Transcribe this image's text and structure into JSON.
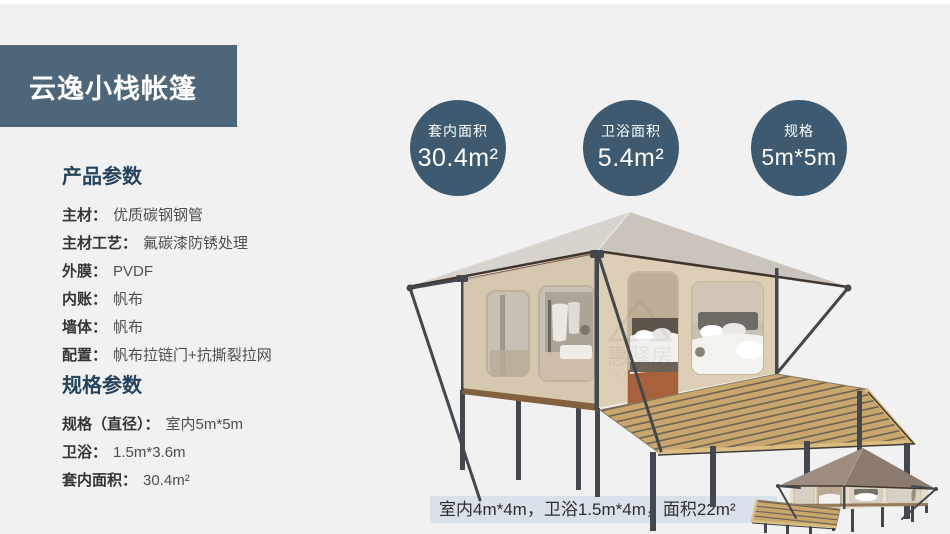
{
  "title_banner": {
    "label": "云逸小栈帐篷"
  },
  "product_params": {
    "heading": "产品参数",
    "items": [
      {
        "label": "主材：",
        "value": "优质碳钢钢管"
      },
      {
        "label": "主材工艺：",
        "value": "氟碳漆防锈处理"
      },
      {
        "label": "外膜：",
        "value": "PVDF"
      },
      {
        "label": "内账：",
        "value": "帆布"
      },
      {
        "label": "墙体：",
        "value": "帆布"
      },
      {
        "label": "配置：",
        "value": "帆布拉链门+抗撕裂拉网"
      }
    ]
  },
  "spec_params": {
    "heading": "规格参数",
    "items": [
      {
        "label": "规格（直径）：",
        "value": "室内5m*5m"
      },
      {
        "label": "卫浴：",
        "value": "1.5m*3.6m"
      },
      {
        "label": "套内面积：",
        "value": "30.4m²"
      }
    ]
  },
  "stat_circles": [
    {
      "label": "套内面积",
      "value": "30.4m²"
    },
    {
      "label": "卫浴面积",
      "value": "5.4m²"
    },
    {
      "label": "规格",
      "value": "5m*5m"
    }
  ],
  "caption": {
    "text": "室内4m*4m，卫浴1.5m*4m，面积22m²"
  },
  "watermark": {
    "text": "惠驿房",
    "subtext": "YIFANT"
  },
  "colors": {
    "page_bg": "#f1f1f2",
    "banner_bg": "#4d6679",
    "heading_color": "#24435f",
    "label_color": "#353535",
    "value_color": "#4f4f4f",
    "circle_bg": "#3d5a70",
    "caption_bg": "#d9e2ea",
    "caption_text": "#2e2e2e",
    "roof_left": "#d9d3cd",
    "roof_right": "#cbc4bc",
    "roof_edge": "#40362d",
    "roof_accent": "#7a4535",
    "wall_side": "#d5c8af",
    "wall_front": "#dccfb5",
    "baseboard": "#82613f",
    "window_glass": "#c7c1b5",
    "door_interior": "#bfae97",
    "floor_red": "#a8613b",
    "deck_tan": "#c9a76c",
    "deck_gap": "#6a6156",
    "deck_edge": "#dcbd80",
    "deck_dark": "#3e3a34",
    "metal": "#43474e",
    "small_roof_left": "#9c8d80",
    "small_roof_right": "#8a7b6e",
    "small_wall": "#e7decb",
    "small_glass": "#d6d1c4"
  }
}
